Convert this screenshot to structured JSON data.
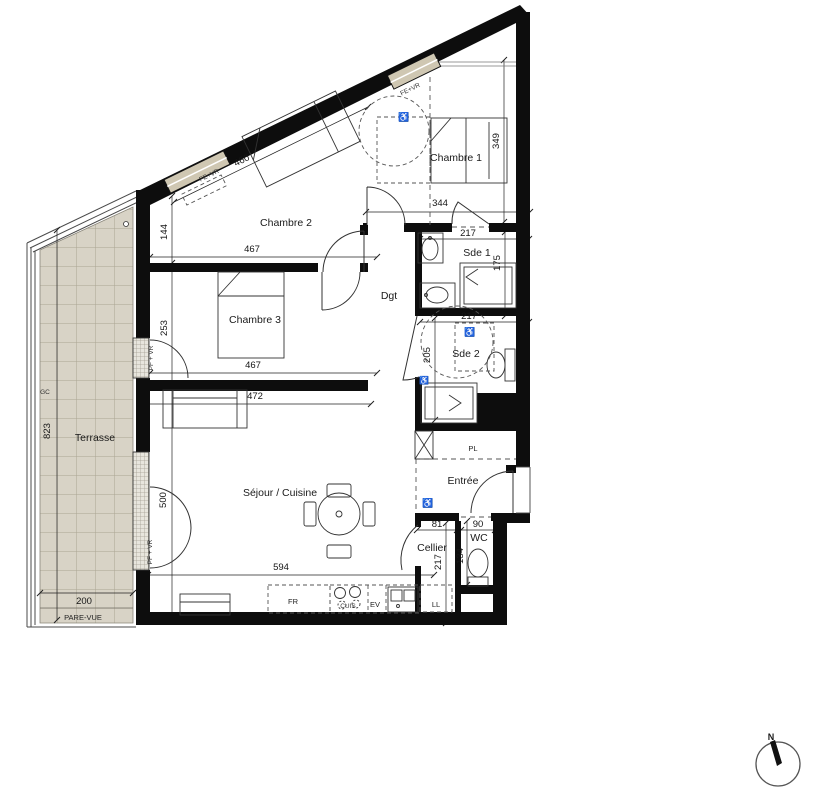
{
  "rooms": {
    "chambre1": {
      "label": "Chambre 1"
    },
    "chambre2": {
      "label": "Chambre 2"
    },
    "chambre3": {
      "label": "Chambre 3"
    },
    "sejour": {
      "label": "Séjour / Cuisine"
    },
    "terrasse": {
      "label": "Terrasse"
    },
    "dgt": {
      "label": "Dgt"
    },
    "sde1": {
      "label": "Sde 1"
    },
    "sde2": {
      "label": "Sde 2"
    },
    "entree": {
      "label": "Entrée"
    },
    "cellier": {
      "label": "Cellier"
    },
    "wc": {
      "label": "WC"
    }
  },
  "fixtures": {
    "placard": "PL",
    "lave_linge": "LL",
    "refrigerateur": "FR",
    "cuisson": "CUIS",
    "evier": "EV",
    "garde_corps": "GC",
    "pare_vue": "PARE-VUE",
    "fenetre_vr_a": "FE+VR",
    "fenetre_vr_b": "FE+VR",
    "porte_fenetre_vr_a": "PF + VR",
    "porte_fenetre_vr_b": "PF + VR",
    "accessibility_symbol": "♿"
  },
  "dimensions_cm": {
    "ch2_diag": "460",
    "ch2_width": "467",
    "ch3_width": "467",
    "sejour_top": "472",
    "sejour_width": "594",
    "chain_144": "144",
    "chain_253": "253",
    "chain_500": "500",
    "terrasse_height": "823",
    "terrasse_width": "200",
    "ch1_depth": "349",
    "ch1_width": "344",
    "sde1_width": "217",
    "sde1_depth": "175",
    "sde2_width": "217",
    "sde2_depth": "205",
    "cellier_width": "81",
    "wc_width": "90",
    "cellier_depth": "217",
    "wc_depth": "134"
  },
  "compass": {
    "north_label": "N"
  },
  "colors": {
    "wall": "#0d0d0d",
    "window_frame": "#cfc7b2",
    "terrace_tile": "#d8d3c6",
    "terrace_grid": "#aaa593",
    "line": "#333333"
  }
}
